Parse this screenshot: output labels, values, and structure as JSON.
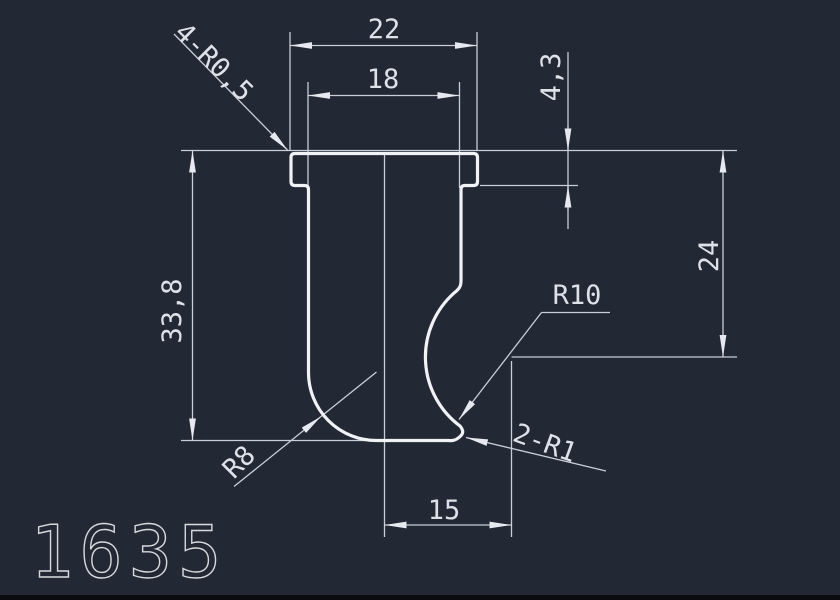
{
  "canvas": {
    "part_number": "1635",
    "background_color": "#222834",
    "outline_color": "#f0f2f5",
    "dim_line_color": "#c9cfd8",
    "text_color": "#dde2e9"
  },
  "dimensions": {
    "flange_width": "22",
    "body_width": "18",
    "flange_thickness": "4,3",
    "overall_height": "33,8",
    "arc_center_height": "24",
    "arc_center_offset": "15"
  },
  "radius_labels": {
    "corner_radii": "4-R0,5",
    "bottom_fillet": "R8",
    "side_concave": "R10",
    "tip_fillets": "2-R1"
  }
}
